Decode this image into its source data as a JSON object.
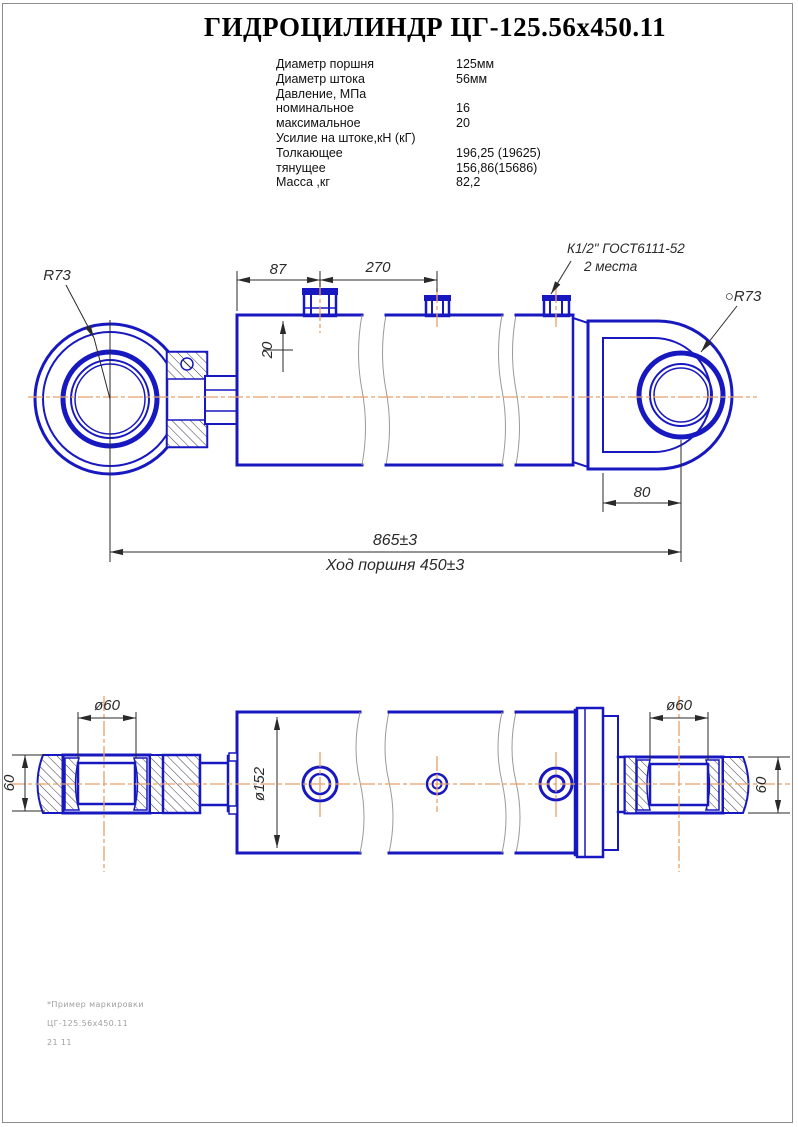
{
  "title": "ГИДРОЦИЛИНДР ЦГ-125.56х450.11",
  "specs": {
    "rows": [
      {
        "label": "Диаметр поршня",
        "value": "125мм"
      },
      {
        "label": "Диаметр штока",
        "value": "56мм"
      },
      {
        "label": "Давление, МПа",
        "value": ""
      },
      {
        "label": "номинальное",
        "value": "16"
      },
      {
        "label": "максимальное",
        "value": "20"
      },
      {
        "label": "Усилие на штоке,кН (кГ)",
        "value": ""
      },
      {
        "label": "Толкающее",
        "value": "196,25 (19625)"
      },
      {
        "label": "тянущее",
        "value": "156,86(15686)"
      },
      {
        "label": "Масса ,кг",
        "value": "82,2"
      }
    ]
  },
  "top_view": {
    "r73_left": "R73",
    "r73_right": "○R73",
    "port_note_line1": "К1/2\" ГОСТ6111-52",
    "port_note_line2": "2 места",
    "dim_87": "87",
    "dim_270": "270",
    "dim_20": "20",
    "dim_80": "80",
    "dim_length": "865±3",
    "dim_stroke": "Ход поршня 450±3"
  },
  "bottom_view": {
    "dia60_left": "ø60",
    "dia60_right": "ø60",
    "dim60_left": "60",
    "dim60_right": "60",
    "dia152": "ø152"
  },
  "footer": {
    "line1": "*Пример маркировки",
    "line2": "ЦГ-125.56х450.11",
    "line3": "21 11"
  },
  "colors": {
    "line_blue": "#1818c0",
    "centerline_orange": "#e8a06a",
    "dim_dark": "#2a2a2a",
    "break_gray": "#9a9a9a",
    "hatch": "#3a3a46",
    "frame_gray": "#8c8c8c",
    "footer_gray": "#a0a0a0"
  }
}
